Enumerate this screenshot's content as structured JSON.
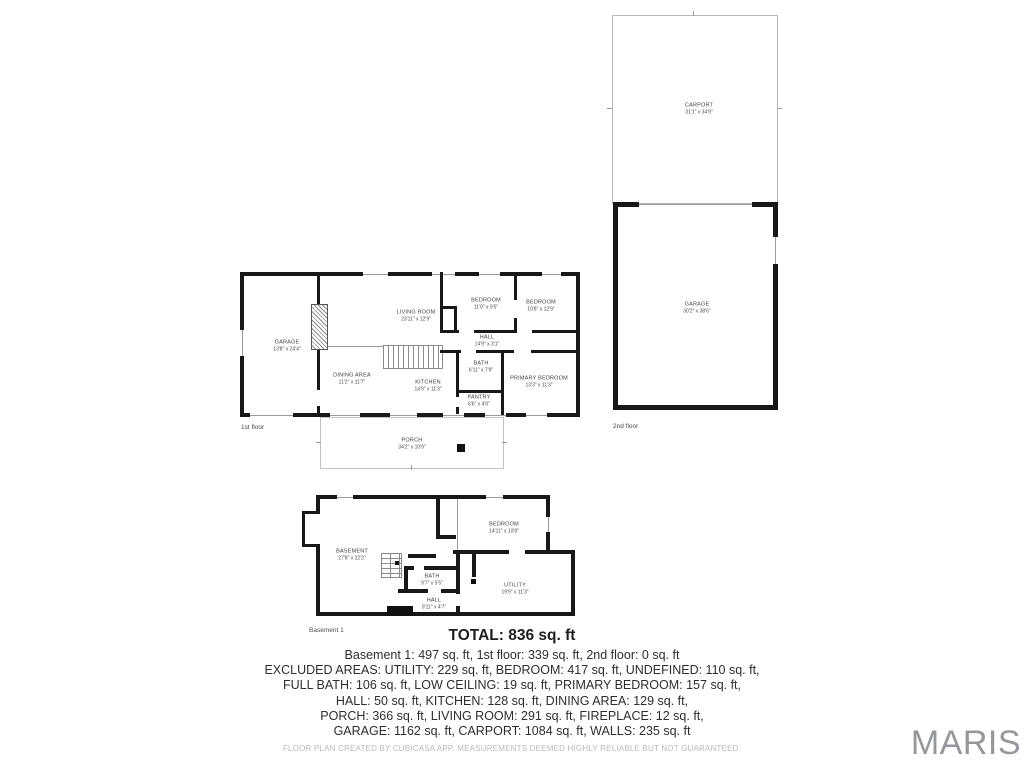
{
  "colors": {
    "wall": "#181818",
    "thin_line": "#9a9a9a",
    "light_outline": "#b7b7b7",
    "room_label_text": "#3f3f3f",
    "summary_text": "#2e2e2e",
    "disclaimer_text": "#b6babd",
    "watermark_text": "#94989c"
  },
  "floors": {
    "second_floor": {
      "label": "2nd floor",
      "carport": {
        "name": "CARPORT",
        "dims": "31'1\" x 34'9\""
      },
      "garage": {
        "name": "GARAGE",
        "dims": "30'2\" x 38'6\""
      }
    },
    "first_floor": {
      "label": "1st floor",
      "garage": {
        "name": "GARAGE",
        "dims": "13'8\" x 24'4\""
      },
      "living_room": {
        "name": "LIVING ROOM",
        "dims": "23'11\" x 12'9\""
      },
      "dining_area": {
        "name": "DINING AREA",
        "dims": "11'2\" x 11'7\""
      },
      "kitchen": {
        "name": "KITCHEN",
        "dims": "14'9\" x 11'3\""
      },
      "bedroom_left": {
        "name": "BEDROOM",
        "dims": "11'0\" x 9'5\""
      },
      "bedroom_right": {
        "name": "BEDROOM",
        "dims": "10'8\" x 12'9\""
      },
      "hall": {
        "name": "HALL",
        "dims": "14'9\" x 3'1\""
      },
      "bath": {
        "name": "BATH",
        "dims": "6'11\" x 7'9\""
      },
      "primary_bedroom": {
        "name": "PRIMARY BEDROOM",
        "dims": "13'3\" x 11'3\""
      },
      "pantry": {
        "name": "PANTRY",
        "dims": "6'6\" x 4'0\""
      },
      "porch": {
        "name": "PORCH",
        "dims": "34'2\" x 10'9\""
      }
    },
    "basement": {
      "label": "Basement 1",
      "basement_room": {
        "name": "BASEMENT",
        "dims": "27'8\" x 22'2\""
      },
      "bedroom": {
        "name": "BEDROOM",
        "dims": "14'11\" x 10'8\""
      },
      "bath": {
        "name": "BATH",
        "dims": "9'7\" x 5'5\""
      },
      "utility": {
        "name": "UTILITY",
        "dims": "19'9\" x 11'3\""
      },
      "hall": {
        "name": "HALL",
        "dims": "9'11\" x 4'7\""
      }
    }
  },
  "summary": {
    "total": "TOTAL: 836 sq. ft",
    "lines": [
      "Basement 1: 497 sq. ft, 1st floor: 339 sq. ft, 2nd floor: 0 sq. ft",
      "EXCLUDED AREAS: UTILITY: 229 sq. ft, BEDROOM: 417 sq. ft, UNDEFINED: 110 sq. ft,",
      "FULL BATH: 106 sq. ft, LOW CEILING: 19 sq. ft, PRIMARY BEDROOM: 157 sq. ft,",
      "HALL: 50 sq. ft, KITCHEN: 128 sq. ft, DINING AREA: 129 sq. ft,",
      "PORCH: 366 sq. ft, LIVING ROOM: 291 sq. ft, FIREPLACE: 12 sq. ft,",
      "GARAGE: 1162 sq. ft, CARPORT: 1084 sq. ft, WALLS: 235 sq. ft"
    ],
    "disclaimer": "FLOOR PLAN CREATED BY CUBICASA APP. MEASUREMENTS DEEMED HIGHLY RELIABLE BUT NOT GUARANTEED.",
    "watermark": "MARIS"
  }
}
